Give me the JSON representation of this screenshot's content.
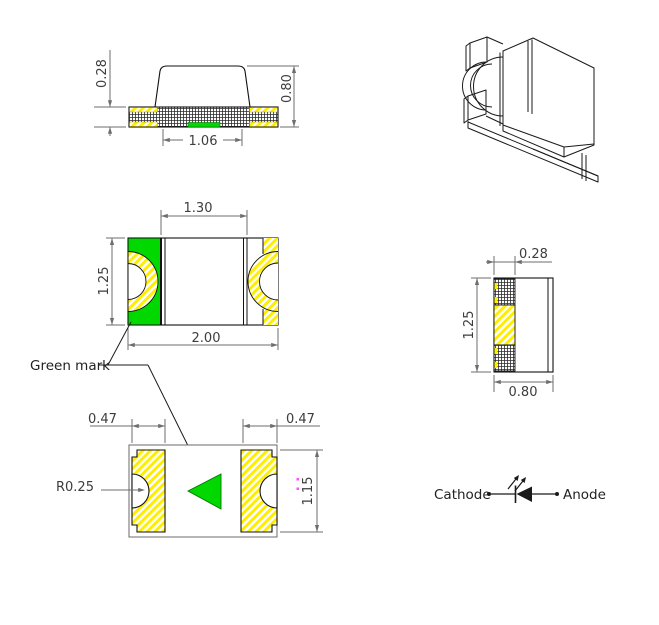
{
  "drawing": {
    "type": "SMD chip LED package dimension drawing",
    "colors": {
      "green_mark": "#00d800",
      "pad_yellow": "#ffee00",
      "outline": "#111111",
      "dimension": "#6e6e6e",
      "accent_magenta": "#ff4dff",
      "background": "#ffffff"
    },
    "views": {
      "side": {
        "dim_terminal_height": "0.28",
        "dim_total_height": "0.80",
        "dim_bottom_width": "1.06"
      },
      "top": {
        "dim_inner_width": "1.30",
        "dim_body_height": "1.25",
        "dim_body_width": "2.00",
        "green_mark_label": "Green mark"
      },
      "end": {
        "dim_terminal_thickness": "0.28",
        "dim_body_height": "1.25",
        "dim_body_width": "0.80"
      },
      "bottom": {
        "dim_pad_width_left": "0.47",
        "dim_pad_width_right": "0.47",
        "dim_notch_radius": "R0.25",
        "dim_pad_height": "1.15"
      },
      "symbol": {
        "cathode_label": "Cathode",
        "anode_label": "Anode"
      }
    }
  }
}
